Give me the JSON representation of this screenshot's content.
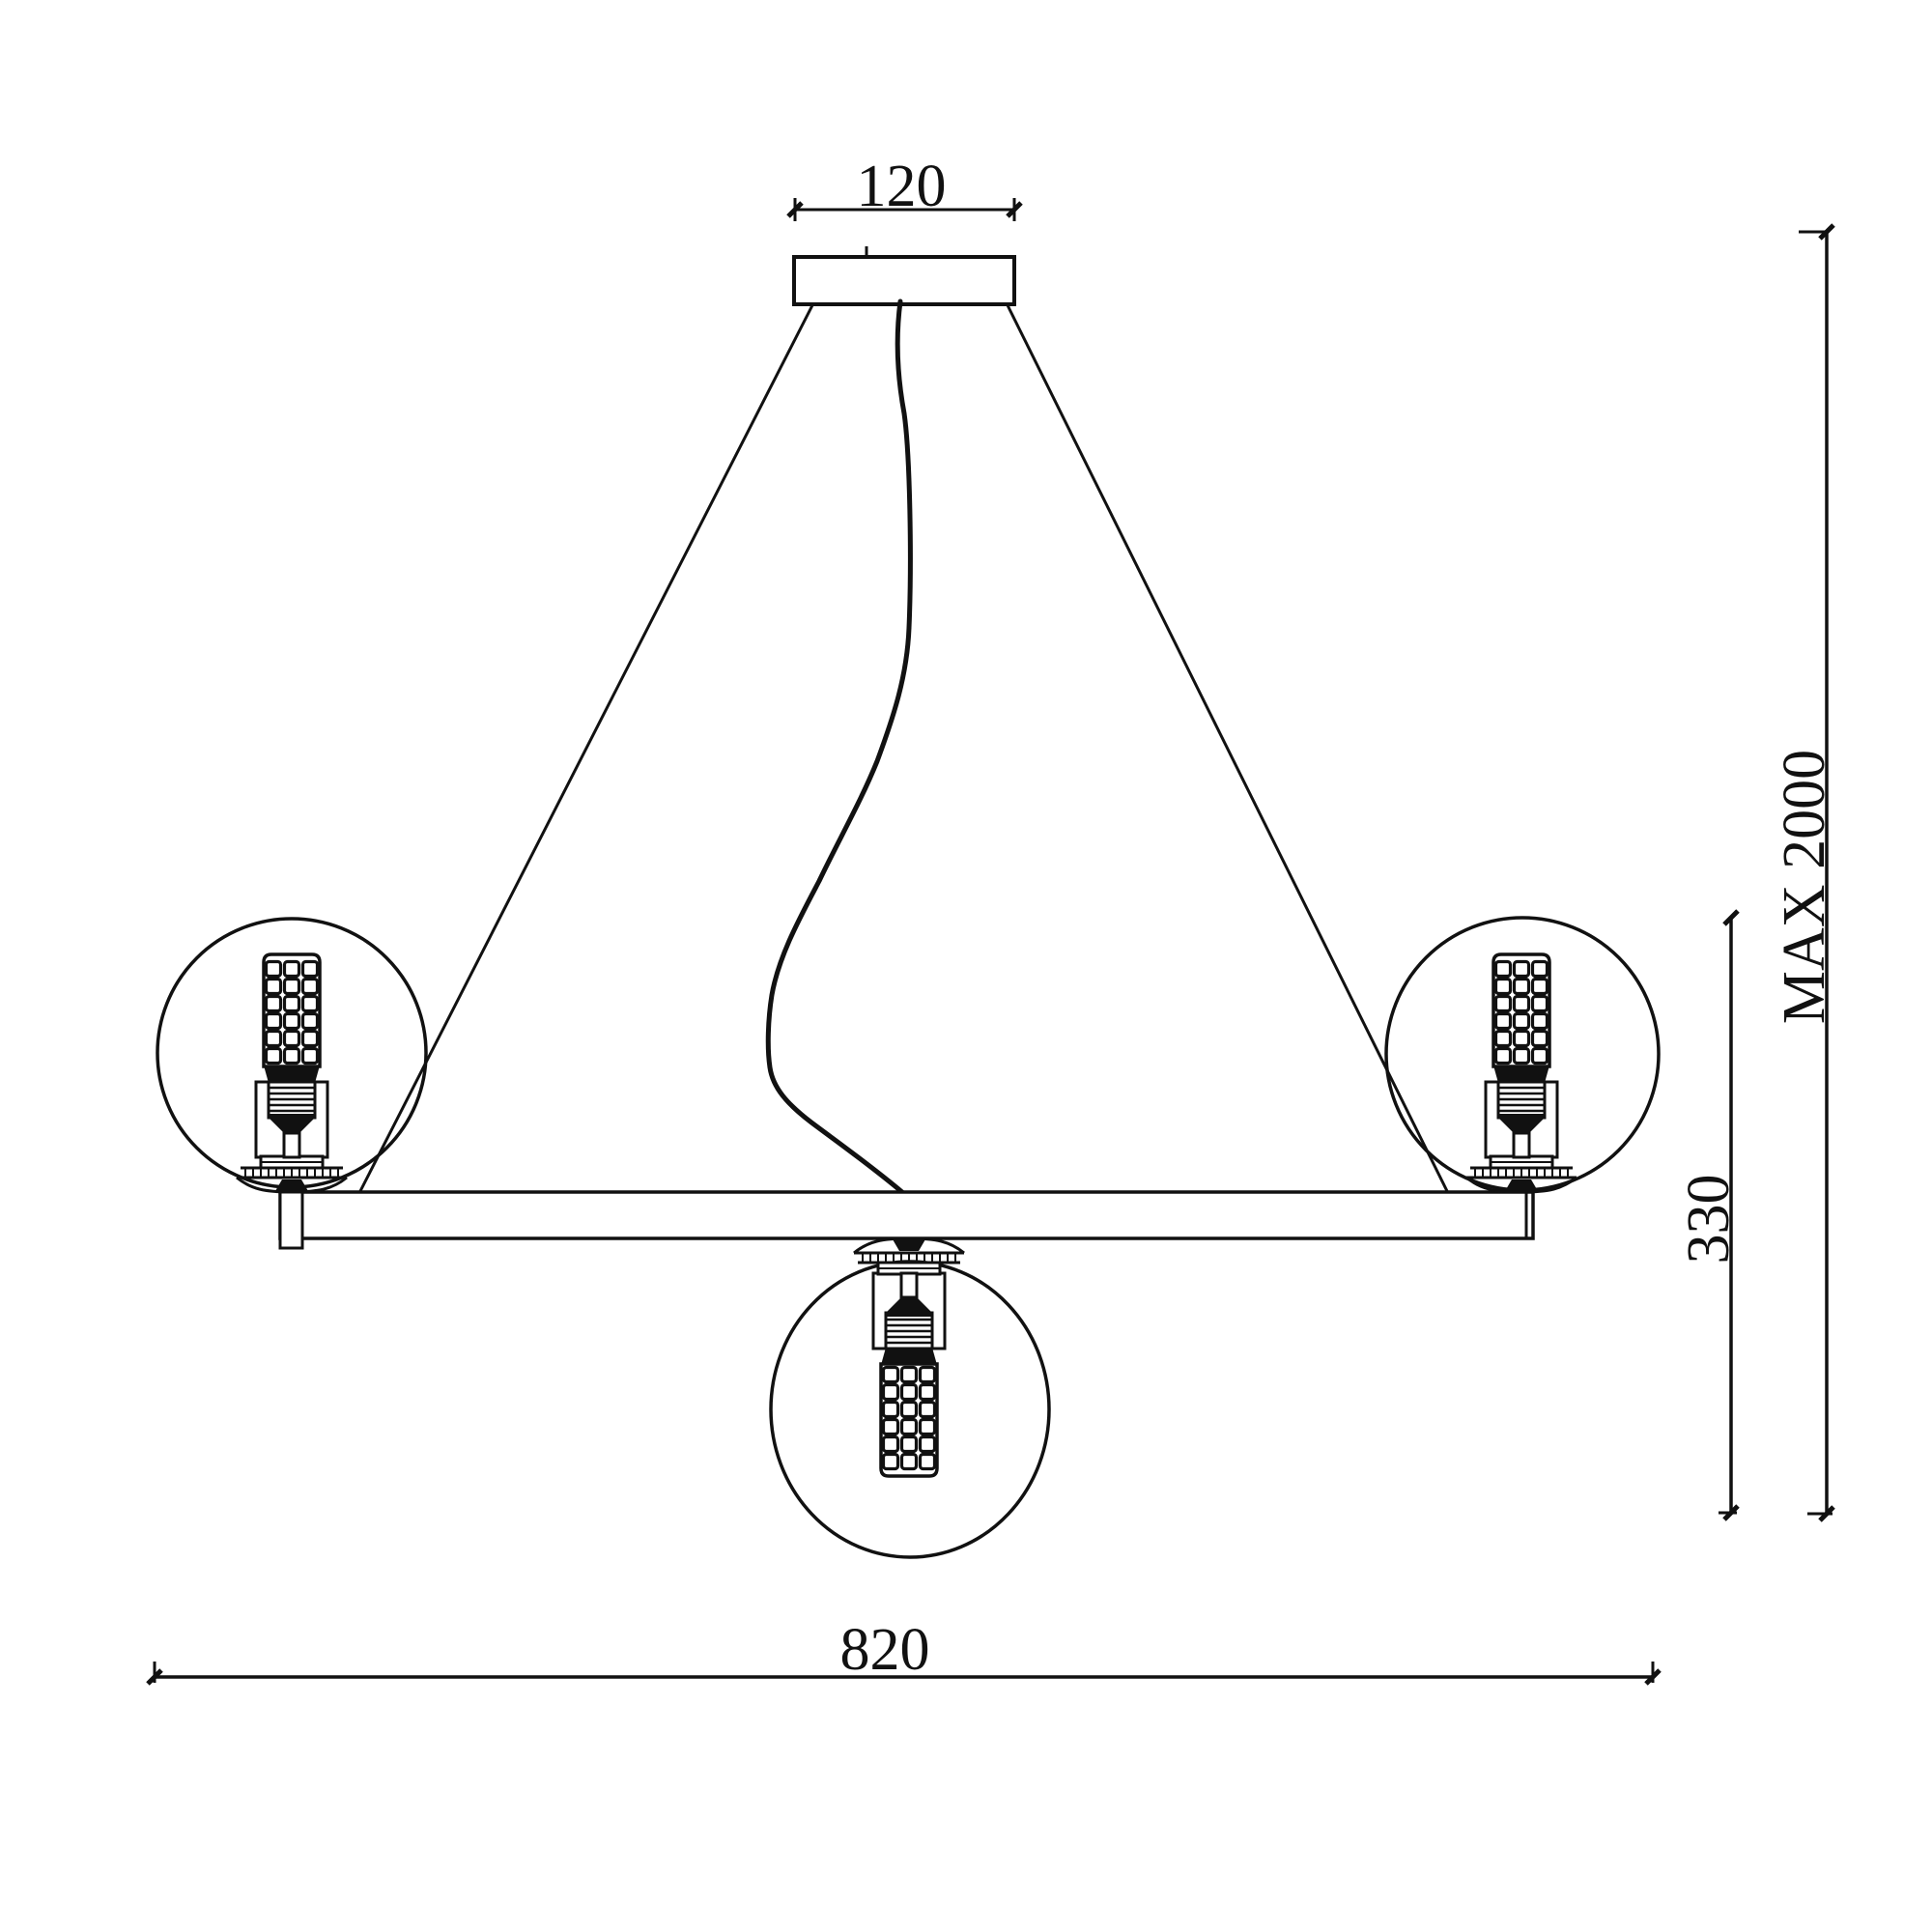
{
  "drawing": {
    "type": "technical dimension drawing",
    "subject": "three-light ring pendant chandelier",
    "dimensions": {
      "canopy_width": "120",
      "max_suspension_height": "MAX 2000",
      "fixture_body_height": "330",
      "fixture_overall_width": "820"
    }
  },
  "colors": {
    "line": "#111111",
    "background": "#ffffff"
  }
}
